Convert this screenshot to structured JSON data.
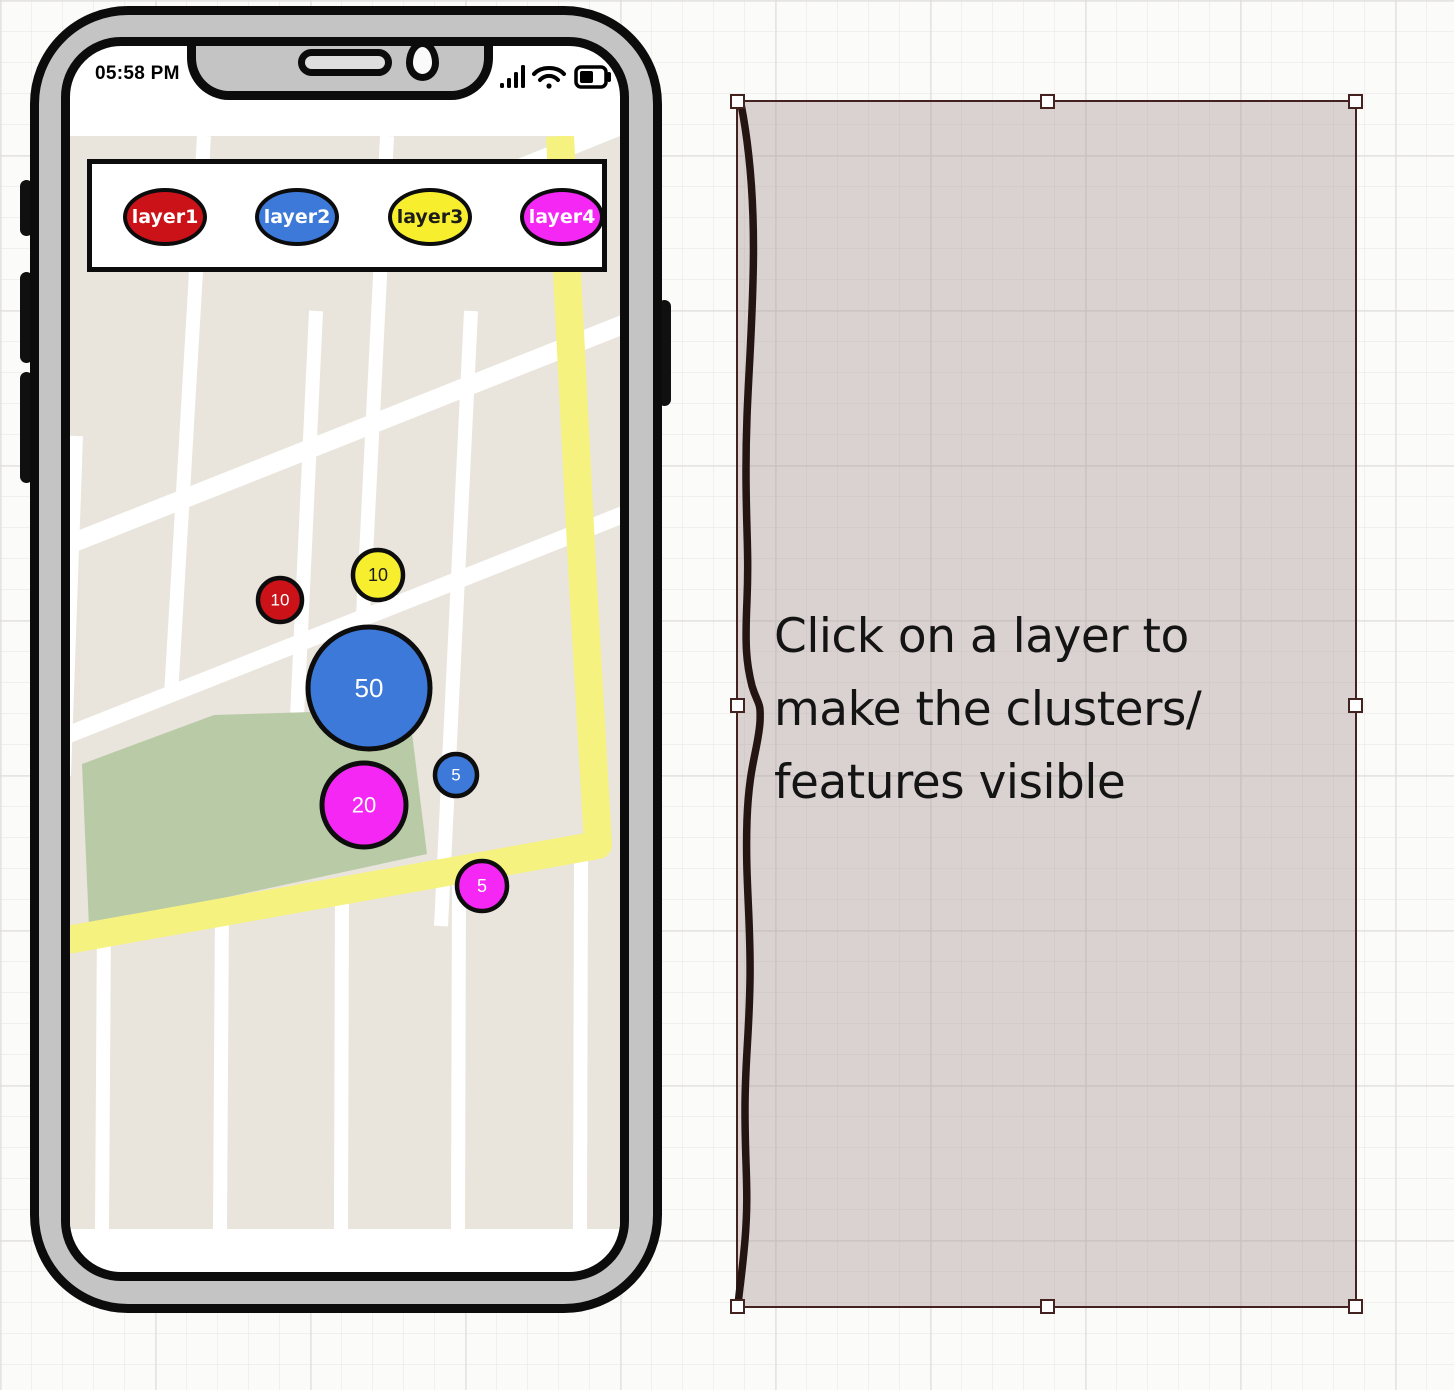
{
  "device": {
    "time": "05:58 PM",
    "status_icons": [
      "cellular-signal-icon",
      "wifi-icon",
      "battery-icon"
    ]
  },
  "layer_bar": {
    "items": [
      {
        "label": "layer1",
        "color": "#cb1219",
        "text_color": "#ffffff"
      },
      {
        "label": "layer2",
        "color": "#3c79d9",
        "text_color": "#ffffff"
      },
      {
        "label": "layer3",
        "color": "#f7ef2d",
        "text_color": "#1c1c1c"
      },
      {
        "label": "layer4",
        "color": "#f527f5",
        "text_color": "#ffffff"
      }
    ]
  },
  "map": {
    "colors": {
      "land": "#e9e5dc",
      "street": "#ffffff",
      "highway": "#f6f280",
      "park": "#b9cba6",
      "outline": "#0d0d0d"
    },
    "clusters": [
      {
        "value": "10",
        "color": "#cb1219",
        "text_color": "#ffffff",
        "x": 210,
        "y": 464,
        "r": 22,
        "font": 17
      },
      {
        "value": "10",
        "color": "#f7ef2d",
        "text_color": "#1c1c1c",
        "x": 308,
        "y": 439,
        "r": 25,
        "font": 18
      },
      {
        "value": "50",
        "color": "#3c79d9",
        "text_color": "#ffffff",
        "x": 299,
        "y": 552,
        "r": 61,
        "font": 26
      },
      {
        "value": "5",
        "color": "#3c79d9",
        "text_color": "#ffffff",
        "x": 386,
        "y": 639,
        "r": 21,
        "font": 17
      },
      {
        "value": "20",
        "color": "#f527f5",
        "text_color": "#ffffff",
        "x": 294,
        "y": 669,
        "r": 42,
        "font": 22
      },
      {
        "value": "5",
        "color": "#f527f5",
        "text_color": "#ffffff",
        "x": 412,
        "y": 750,
        "r": 25,
        "font": 18
      }
    ]
  },
  "annotation": {
    "lines": [
      "Click on a layer to",
      "make the clusters/",
      "features visible"
    ]
  }
}
